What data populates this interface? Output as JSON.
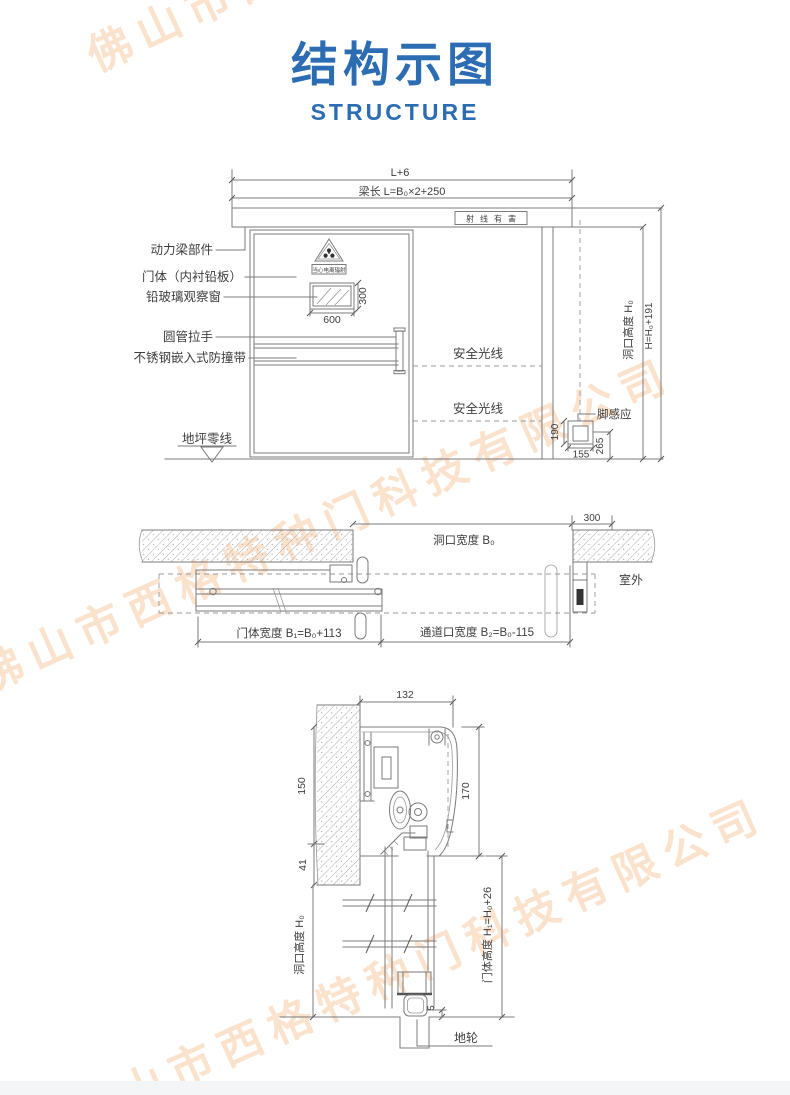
{
  "page": {
    "title": "结构示图",
    "subtitle": "STRUCTURE",
    "accent_color": "#2b6cb3"
  },
  "watermark": {
    "text": "佛山市西格特种门科技有限公司",
    "color": "#f0a25e"
  },
  "front_view": {
    "dim_overall": "L+6",
    "dim_beam": "梁长 L=B₀×2+250",
    "sign_ray": "射线有害",
    "sign_caution": "当心电离辐射",
    "label_power_beam": "动力梁部件",
    "label_door_body": "门体（内衬铅板）",
    "label_window": "铅玻璃观察窗",
    "label_handle": "圆管拉手",
    "label_bumper": "不锈钢嵌入式防撞带",
    "label_floor_zero": "地坪零线",
    "label_safety_light_upper": "安全光线",
    "label_safety_light_lower": "安全光线",
    "label_foot_sensor": "脚感应",
    "dim_window_width": "600",
    "dim_window_height": "300",
    "dim_sensor_height": "190",
    "dim_sensor_width": "155",
    "dim_sensor_floor": "265",
    "dim_opening_height": "洞口高度 H₀",
    "dim_total_height": "H=H₀+191"
  },
  "plan_view": {
    "dim_opening_width": "洞口宽度 B₀",
    "dim_wall_return": "300",
    "label_outdoor": "室外",
    "dim_door_width": "门体宽度 B₁=B₀+113",
    "dim_passage_width": "通道口宽度 B₂=B₀-115"
  },
  "section_view": {
    "dim_track_width": "132",
    "dim_track_height": "150",
    "dim_cover_height": "170",
    "dim_lintel": "41",
    "dim_opening_height": "洞口高度 H₀",
    "dim_door_height": "门体高度 H₁=H₀+26",
    "dim_wheel_clearance": "5",
    "label_ground_wheel": "地轮"
  }
}
